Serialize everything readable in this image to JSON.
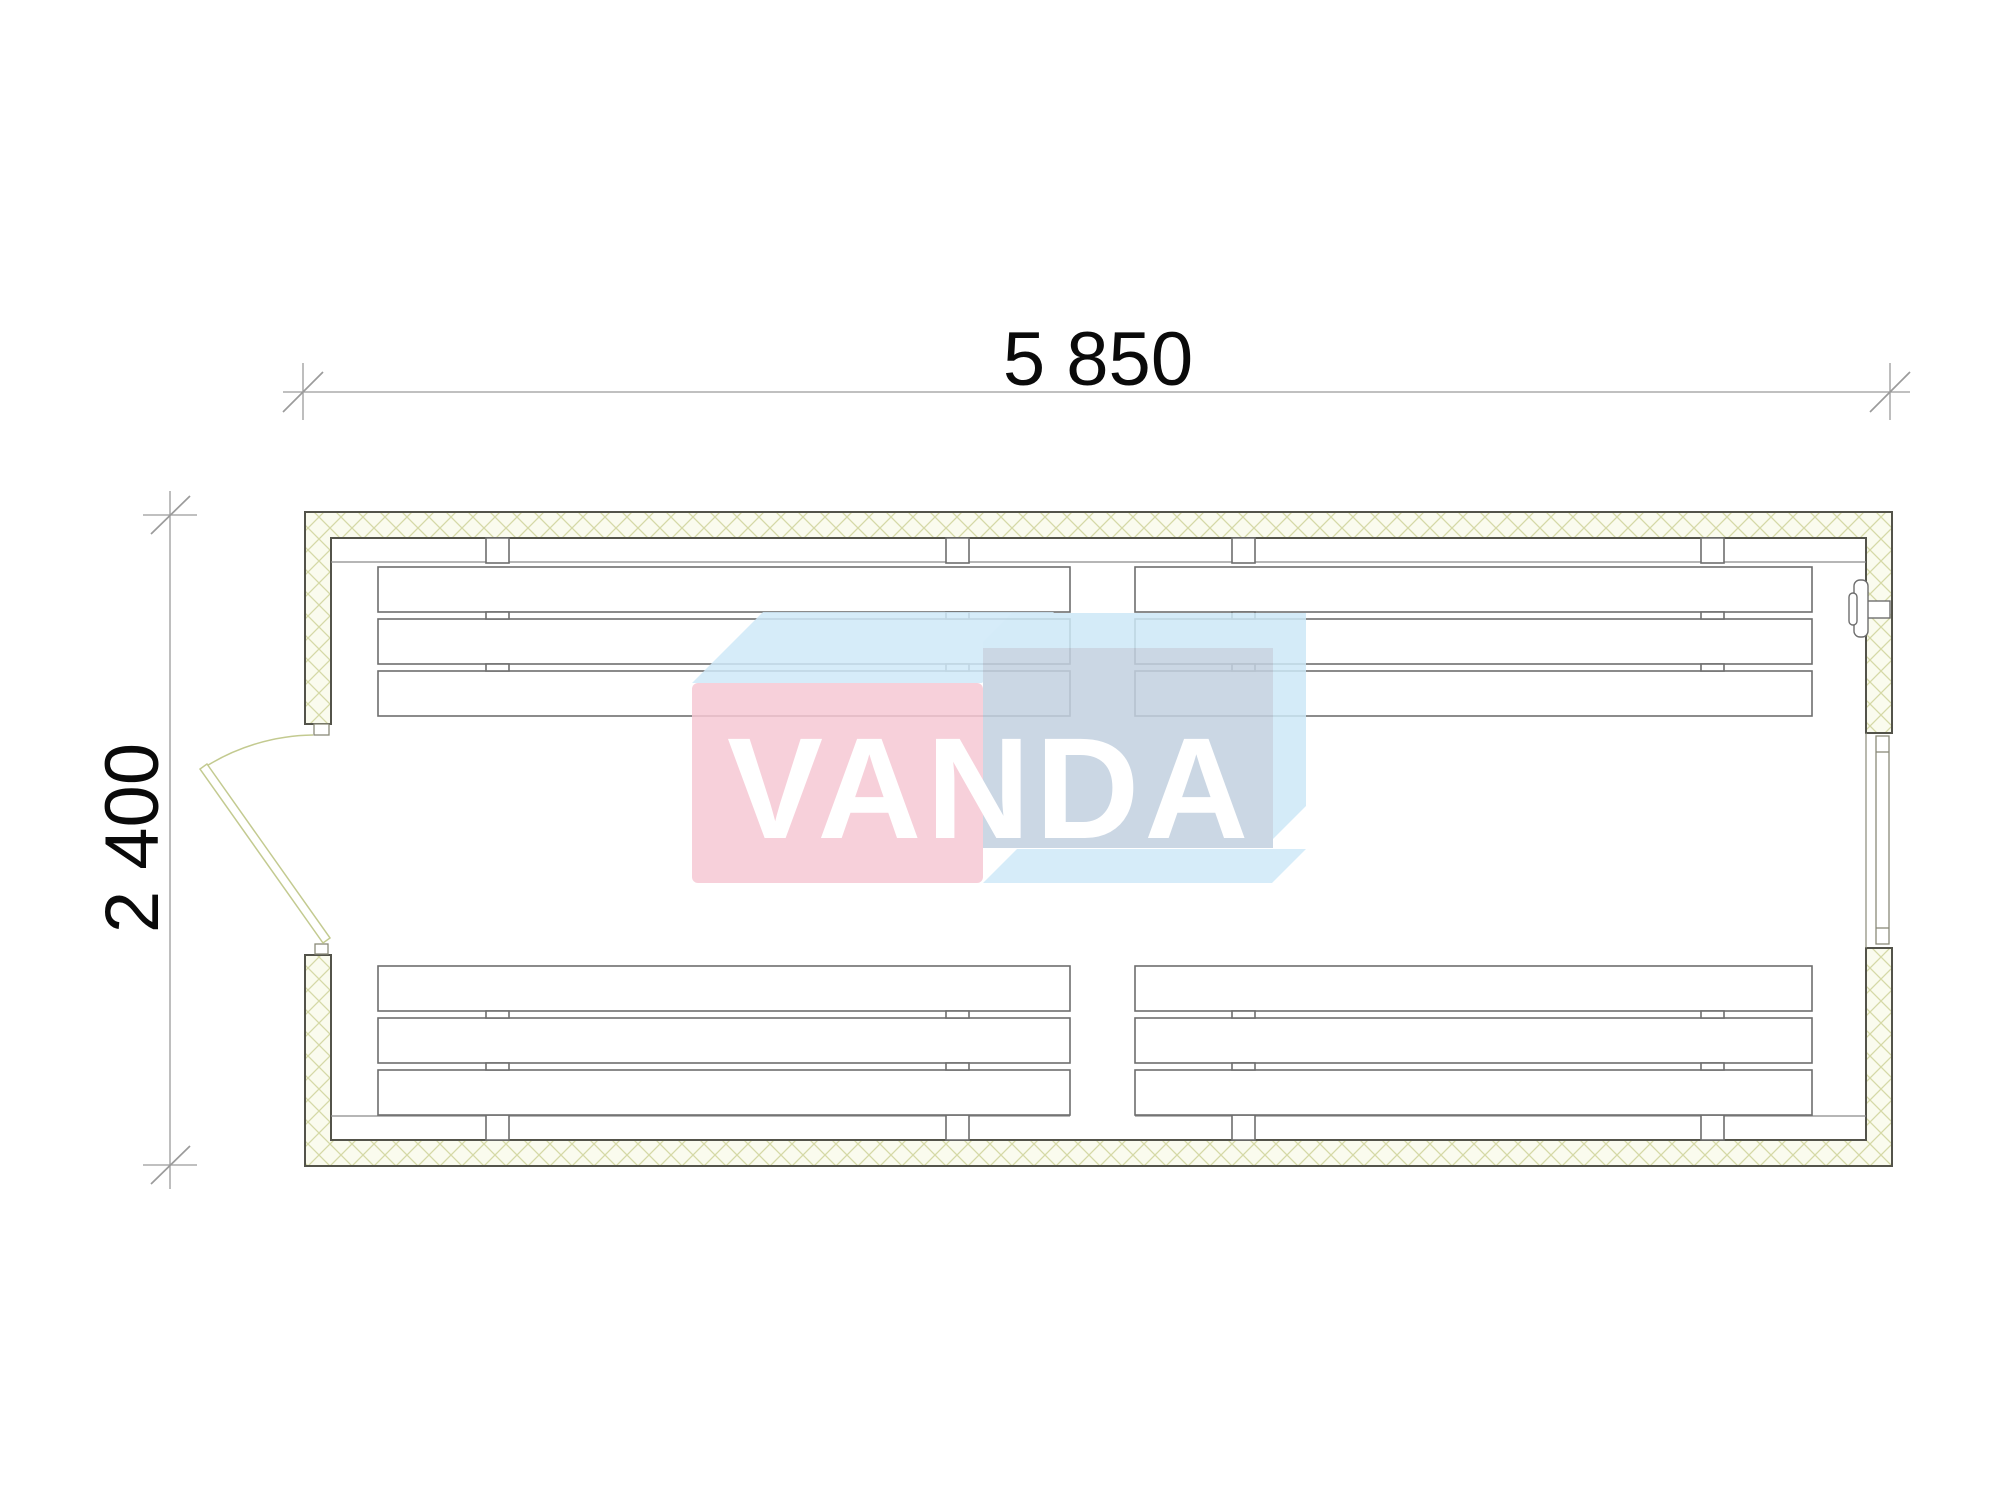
{
  "drawing": {
    "dimensions": {
      "width_label": "5 850",
      "height_label": "2 400"
    },
    "watermark": {
      "text": "VANDA",
      "text_color": "#ffffff",
      "pink": "#f6c8d4",
      "light_blue": "#cfe9f8",
      "mid_blue": "#cde8f7",
      "grey_blue": "#c3d1e0"
    },
    "colors": {
      "wall_outline": "#53534a",
      "hatch_line": "#d5d9a6",
      "hatch_bg": "#fafbee",
      "furniture_line": "#6e6e6e",
      "rail_line": "#8a8a8a",
      "dim_line": "#9b9b9b",
      "door_line": "#c3ca90",
      "jamb_line": "#8a8a78"
    },
    "plan": {
      "bench_sections": 4,
      "slats_per_section": 3,
      "door_wall": "left",
      "window_wall": "right"
    }
  }
}
